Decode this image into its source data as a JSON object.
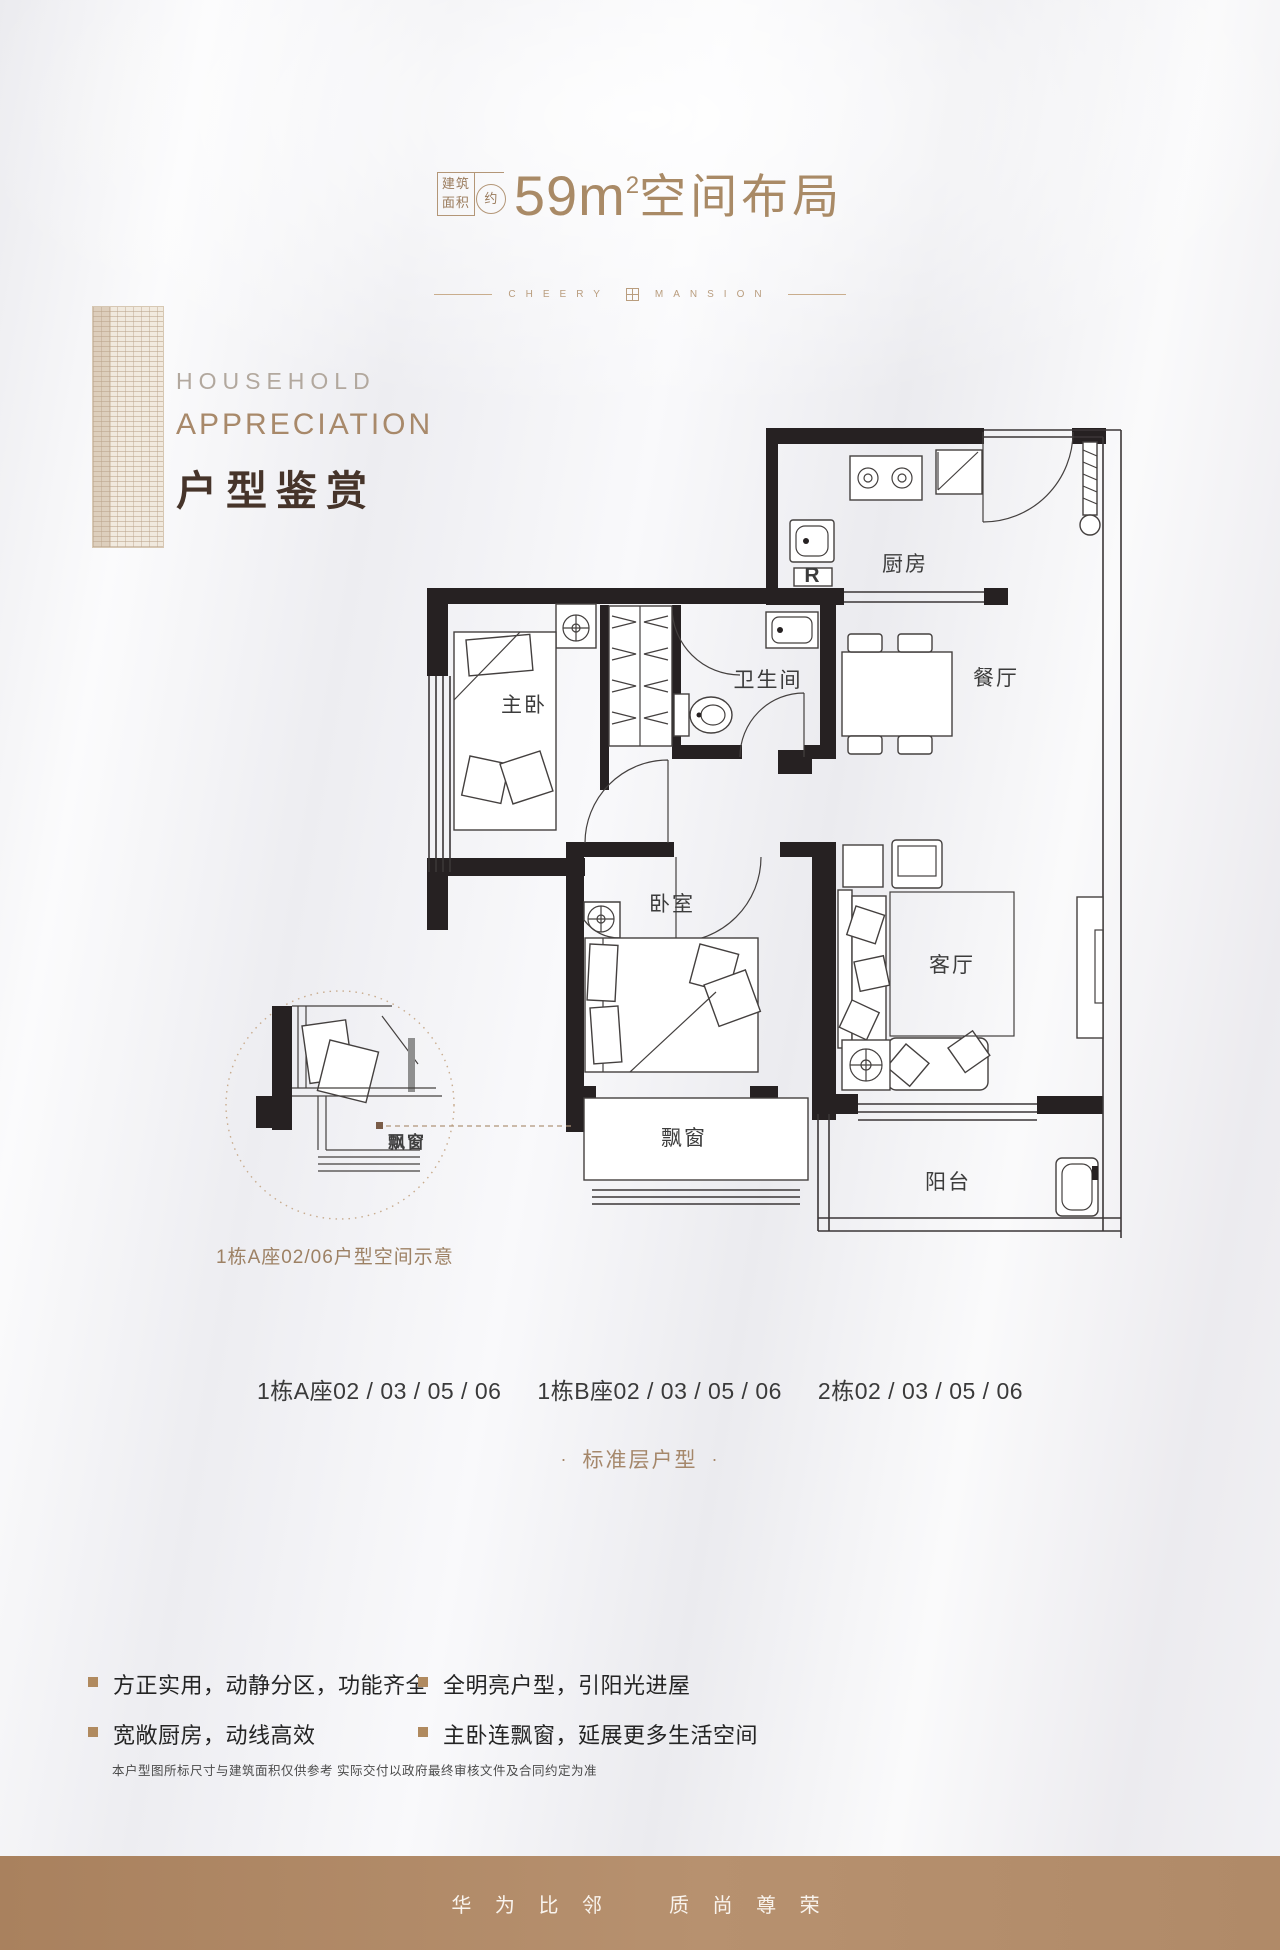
{
  "title": {
    "box1": "建筑",
    "box2": "面积",
    "approx": "约",
    "value": "59m",
    "sup": "2",
    "suffix": "空间布局"
  },
  "divider": {
    "left": "CHEERY",
    "right": "MANSION"
  },
  "heading": {
    "en1": "HOUSEHOLD",
    "en2": "APPRECIATION",
    "zh": "户型鉴赏"
  },
  "plan": {
    "rooms": {
      "kitchen": "厨房",
      "dining": "餐厅",
      "bathroom": "卫生间",
      "master_bedroom": "主卧",
      "bedroom": "卧室",
      "living": "客厅",
      "bay_window": "飘窗",
      "balcony": "阳台",
      "fridge": "R"
    },
    "detail_label": "飘窗",
    "caption": "1栋A座02/06户型空间示意"
  },
  "units": {
    "g1": "1栋A座02 / 03 / 05 / 06",
    "g2": "1栋B座02 / 03 / 05 / 06",
    "g3": "2栋02 / 03 / 05 / 06"
  },
  "floor_type": {
    "dot": "·",
    "label": "标准层户型"
  },
  "site_map": {
    "north": "N",
    "labels": [
      "3#",
      "10#",
      "1A#"
    ]
  },
  "features": [
    {
      "text": "方正实用，动静分区，功能齐全"
    },
    {
      "text": "宽敞厨房，动线高效"
    },
    {
      "text": "全明亮户型，引阳光进屋"
    },
    {
      "text": "主卧连飘窗，延展更多生活空间"
    }
  ],
  "disclaimer": "本户型图所标尺寸与建筑面积仅供参考 实际交付以政府最终审核文件及合同约定为准",
  "footer": {
    "left": "华 为 比 邻",
    "right": "质 尚 尊 荣"
  },
  "colors": {
    "accent": "#a98a66",
    "heading_zh": "#46342a",
    "plan_ink": "#262122",
    "caption": "#9d8164",
    "footer_bg": "#b08a68",
    "bullet": "#b08a5f"
  }
}
